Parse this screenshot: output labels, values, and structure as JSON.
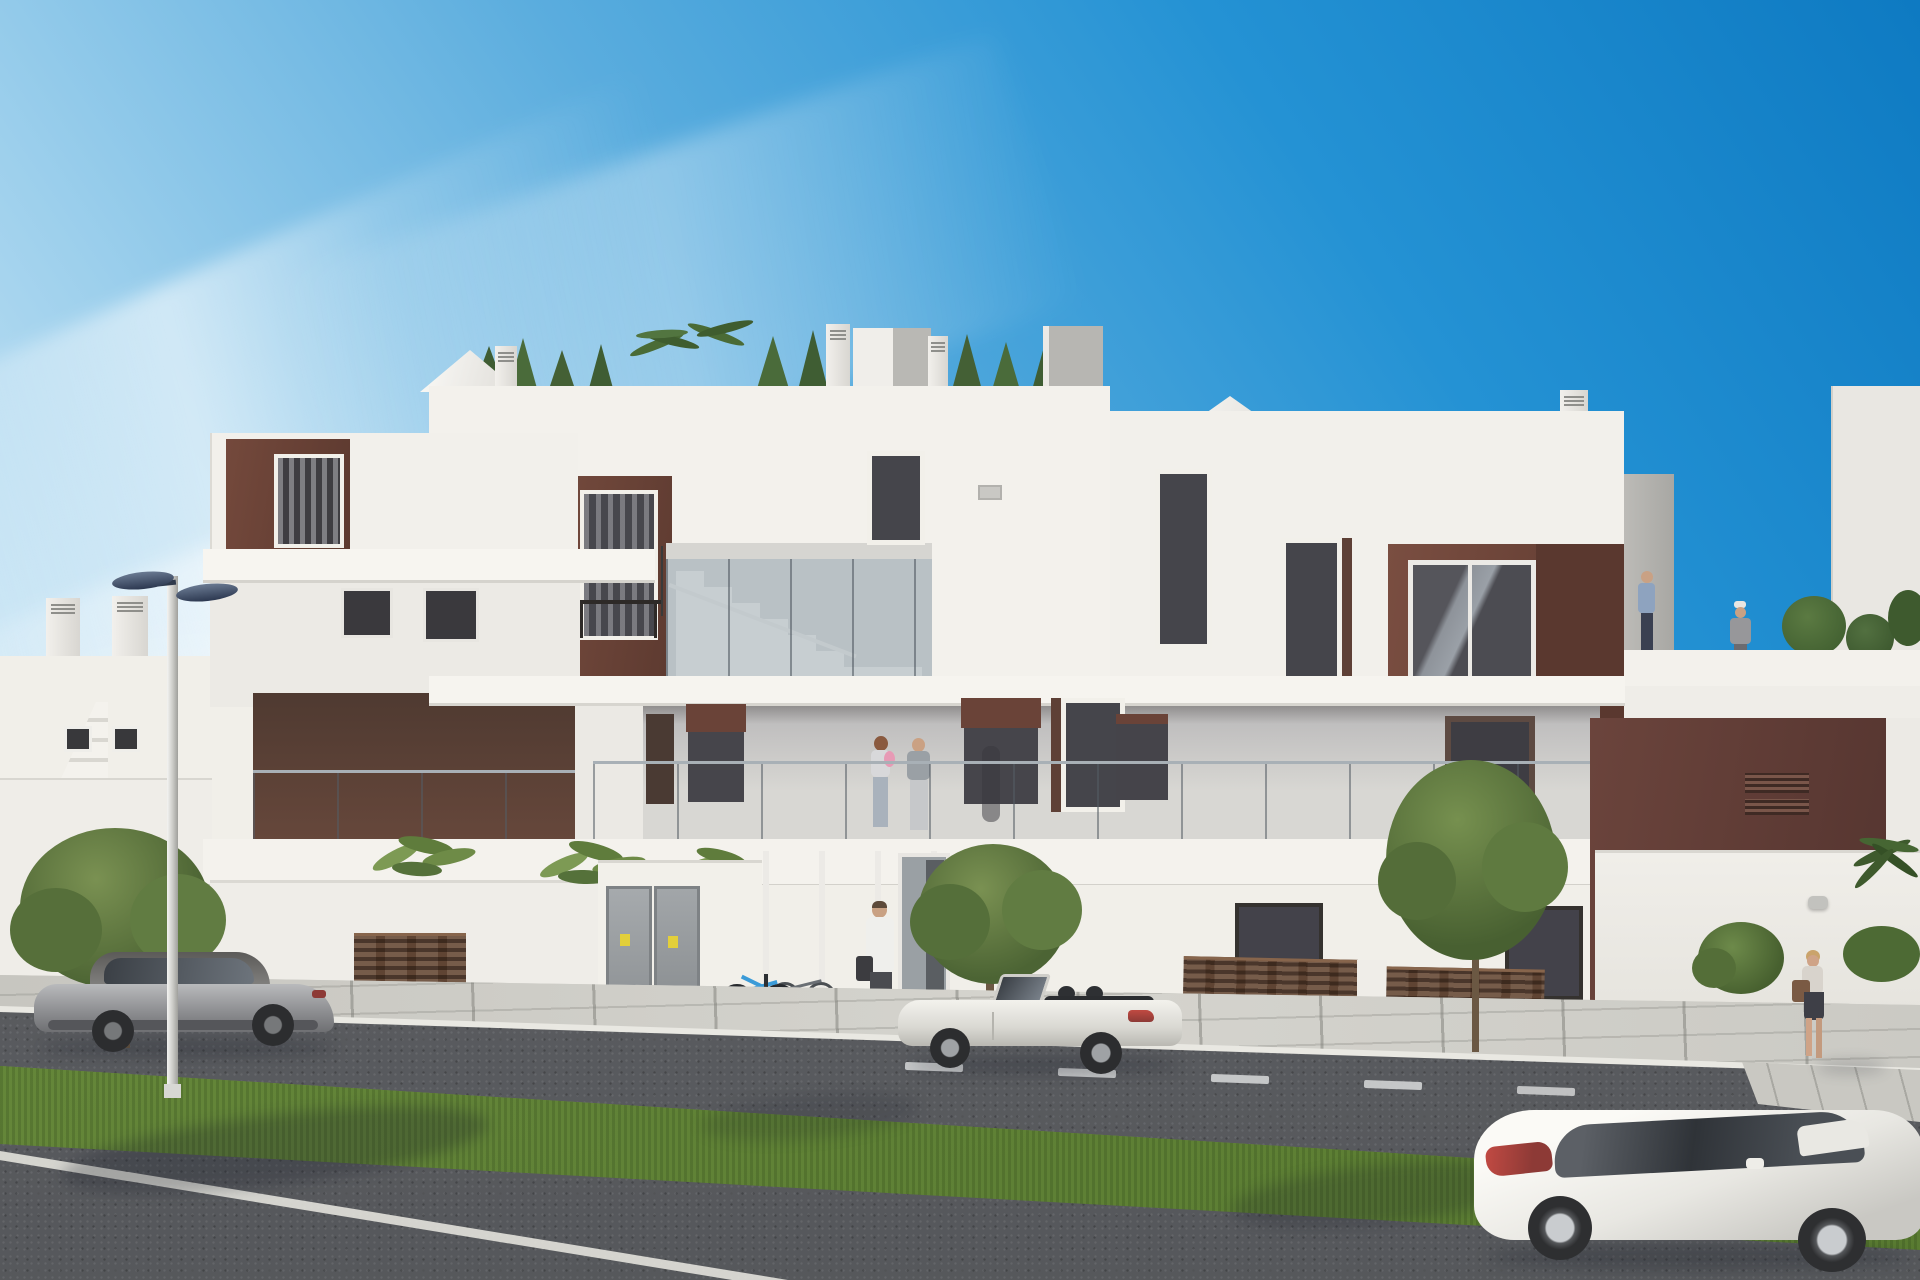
{
  "meta": {
    "title": "New-build apartment complex – exterior 3D visualization",
    "type": "photorealistic architectural render, street elevation",
    "time_of_day": "clear sunny day"
  },
  "palette": {
    "sky_deep": "#0f7ec6",
    "sky_horizon": "#d7ecf8",
    "facade_white": "#f2f0eb",
    "facade_shade": "#d9d7d2",
    "accent_brown": "#6a4338",
    "accent_maroon": "#5e3b35",
    "window_glass": "#45454b",
    "balustrade_glass": "#9fb4c2",
    "asphalt": "#5d5f63",
    "grass": "#6a8c3c",
    "sidewalk": "#d0cfc9",
    "fence_wood": "#5f4433"
  },
  "objects": {
    "sky": {
      "label": "Clear blue sky with wispy cirrus clouds"
    },
    "building": {
      "label": "Modern three-storey white apartment building with brown accent panels, glass balconies and roof terraces"
    },
    "neighbor_building": {
      "label": "Neighbouring white building with external staircase and chimneys"
    },
    "roof_garden": {
      "label": "Roof terrace greenery with conifers, palms and parasols"
    },
    "staircase": {
      "label": "Internal staircase behind glass balustrade"
    },
    "entrance": {
      "label": "Glazed communal entrance with bicycle stand"
    },
    "utility_cabinets": {
      "label": "Grey utility cabinets with warning stickers"
    },
    "car_left": {
      "label": "Silver sports coupe parked at the kerb"
    },
    "car_center": {
      "label": "White convertible roadster parked by the entrance"
    },
    "car_right": {
      "label": "White sports coupe on the near lane"
    },
    "street_lamp": {
      "label": "Twin-arm street lamp"
    },
    "balcony_family": {
      "label": "Couple with baby standing on first-floor balcony"
    },
    "entrance_man": {
      "label": "Man with bag walking to the entrance"
    },
    "sidewalk_woman": {
      "label": "Woman with handbag walking along the sidewalk"
    },
    "roof_people": {
      "label": "Man and woman on the roof terrace"
    },
    "road": {
      "label": "Asphalt road with dashed white lane markings"
    },
    "grass_median": {
      "label": "Green grass median strip"
    },
    "sidewalk": {
      "label": "Paved sidewalk with large slabs"
    },
    "fences": {
      "label": "Brown slatted privacy fences and gates"
    },
    "trees": {
      "label": "Young street trees and banana plants"
    }
  }
}
